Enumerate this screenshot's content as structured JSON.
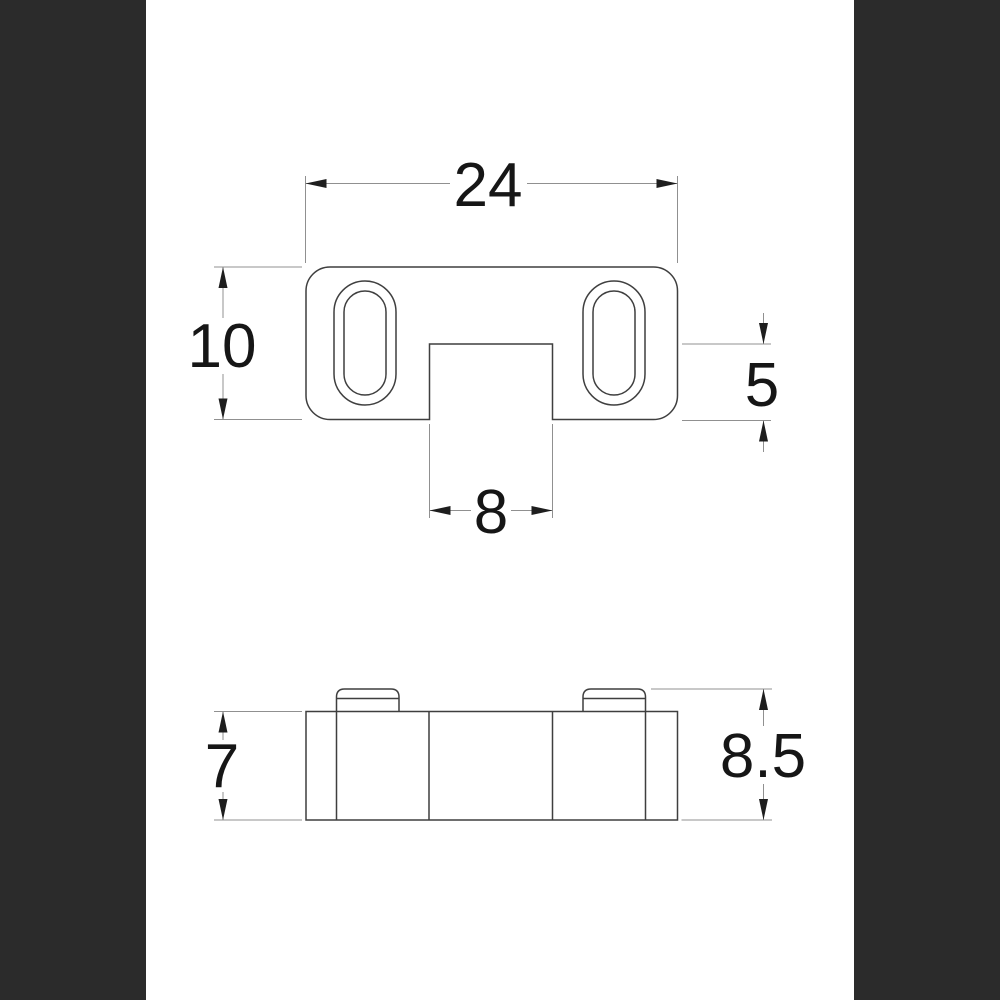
{
  "drawing": {
    "kind": "engineering dimension drawing",
    "views": {
      "top": {
        "name": "top-view",
        "dims": {
          "width": "24",
          "height": "10",
          "notch_width": "8",
          "notch_depth": "5"
        }
      },
      "side": {
        "name": "side-view",
        "dims": {
          "body_height": "7",
          "overall_height": "8.5"
        }
      }
    }
  },
  "colors": {
    "canvas": "#ffffff",
    "letterbox": "#2b2b2b",
    "outline": "#3f3f3f",
    "dimension_line": "#909090",
    "arrow": "#1e1e1e",
    "text": "#161616"
  }
}
